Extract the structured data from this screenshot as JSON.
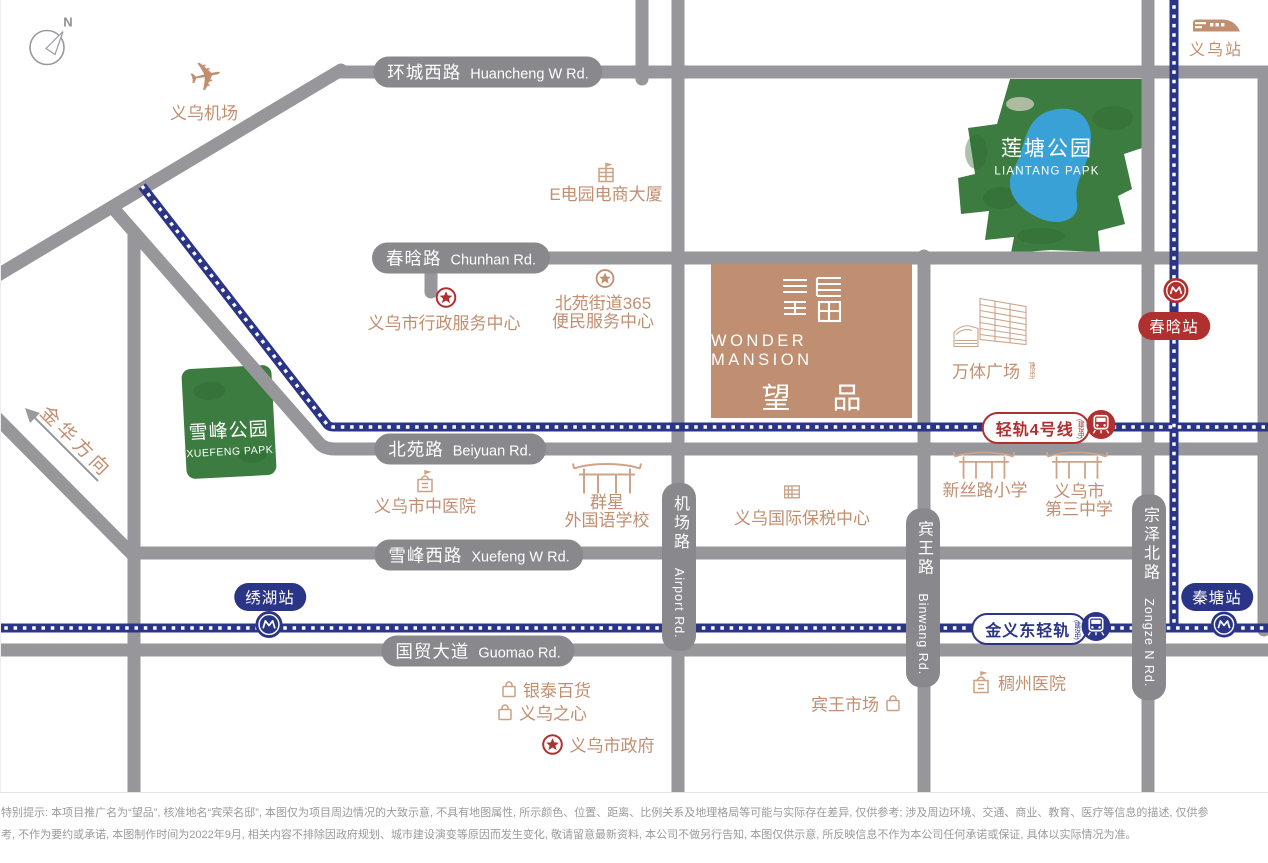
{
  "icons": {
    "plane": "✈",
    "north": "N"
  },
  "roads": {
    "huancheng": {
      "zh": "环城西路",
      "en": "Huancheng W Rd."
    },
    "chunhan": {
      "zh": "春晗路",
      "en": "Chunhan Rd."
    },
    "beiyuan": {
      "zh": "北苑路",
      "en": "Beiyuan Rd."
    },
    "xuefeng_w": {
      "zh": "雪峰西路",
      "en": "Xuefeng W Rd."
    },
    "guomao": {
      "zh": "国贸大道",
      "en": "Guomao Rd."
    },
    "jichang": {
      "zh": "机场路",
      "en": "Airport Rd."
    },
    "binwang": {
      "zh": "宾王路",
      "en": "Binwang Rd."
    },
    "zongze": {
      "zh": "宗泽北路",
      "en": "Zongze N Rd."
    }
  },
  "rails": {
    "line4": {
      "label": "轻轨4号线",
      "note": "(建设中)"
    },
    "jinyidong": {
      "label": "金义东轻轨",
      "note": "(建设中)"
    }
  },
  "stations": {
    "yiwu": "义乌站",
    "chunhan": "春晗站",
    "xiuhu": "绣湖站",
    "qintang": "秦塘站"
  },
  "parks": {
    "liantang": {
      "zh": "莲塘公园",
      "en": "LIANTANG PAPK"
    },
    "xuefeng": {
      "zh": "雪峰公园",
      "en": "XUEFENG PAPK"
    }
  },
  "project": {
    "en": "WONDER MANSION",
    "zh": "望 品"
  },
  "pois": {
    "airport": "义乌机场",
    "edian": "E电园电商大厦",
    "xingzheng": "义乌市行政服务中心",
    "by365_1": "北苑街道365",
    "by365_2": "便民服务中心",
    "wanti": "万体广场",
    "wanti_note": "(建设中)",
    "zhongyiyuan": "义乌市中医院",
    "qunxing_1": "群星",
    "qunxing_2": "外国语学校",
    "baoshui": "义乌国际保税中心",
    "xinsilu": "新丝路小学",
    "sanzhong_1": "义乌市",
    "sanzhong_2": "第三中学",
    "yintai": "银泰百货",
    "yiwuzhixin": "义乌之心",
    "shizhengfu": "义乌市政府",
    "binwang_market": "宾王市场",
    "chouzhou": "稠州医院"
  },
  "direction": {
    "jinhua": "金华方向"
  },
  "colors": {
    "road_gray": "#97979b",
    "capsule_gray": "#88888d",
    "rail_navy": "#2b3588",
    "badge_red": "#b0302f",
    "poi_tan": "#c18f70",
    "project_block": "#c08e71",
    "park_green": "#3d7c41",
    "lake_blue": "#39a1d5"
  },
  "disclaimer": {
    "line1": "特别提示: 本项目推广名为“望品”, 核准地名“宾荣名邸”, 本图仅为项目周边情况的大致示意, 不具有地图属性, 所示颜色、位置、距离、比例关系及地理格局等可能与实际存在差异, 仅供参考; 涉及周边环境、交通、商业、教育、医疗等信息的描述, 仅供参",
    "line2": "考, 不作为要约或承诺, 本图制作时间为2022年9月, 相关内容不排除因政府规划、城市建设演变等原因而发生变化, 敬请留意最新资料, 本公司不做另行告知, 本图仅供示意, 所反映信息不作为本公司任何承诺或保证, 具体以实际情况为准。"
  }
}
